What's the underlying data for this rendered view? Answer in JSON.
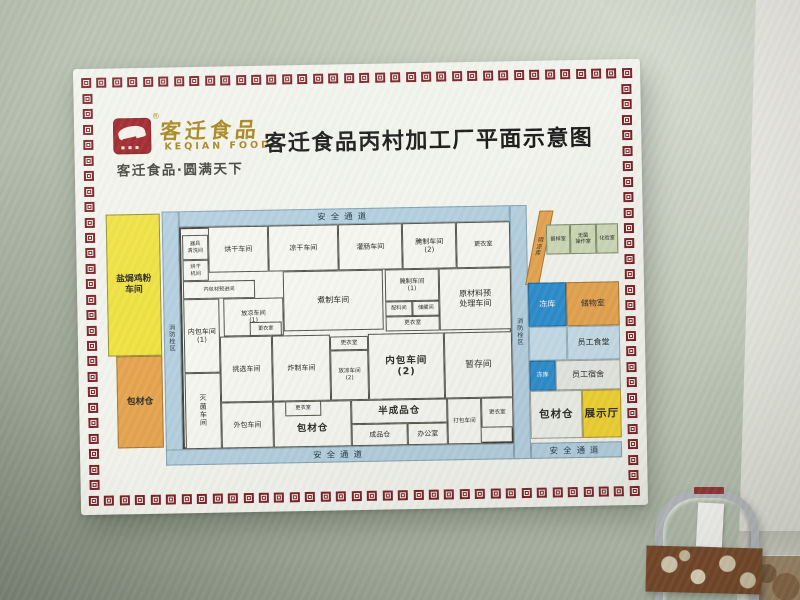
{
  "sign": {
    "logo": {
      "brand_cn": "客迁食品",
      "brand_en": "KEQIAN FOOD",
      "registered": "®",
      "slogan": "客迁食品·圆满天下"
    },
    "title": "客迁食品丙村加工厂平面示意图",
    "plan": {
      "corridors": {
        "top": "安全通道",
        "bottom": "安全通道",
        "bottom_east": "安全通道",
        "west_strip": "消\n防\n栓\n区",
        "east_strip": "消\n防\n栓\n区"
      },
      "west_rooms": {
        "salt_baked_chicken_workshop": "盐焗鸡粉\n车间",
        "packaging_material_warehouse_west": "包材仓"
      },
      "building_rooms": {
        "utensil_washing_room": "器具\n清洗间",
        "drying_machine_room": "烘干\n机间",
        "inner_pack_material_pre_room": "内包材预进间",
        "drying_workshop": "烘干车间",
        "air_drying_workshop": "凉干车间",
        "sausage_filling_workshop": "灌肠车间",
        "curing_workshop_2": "腌制车间\n(2)",
        "changing_room_ne": "更衣室",
        "cooling_workshop_1": "放凉车间\n(1)",
        "boiling_workshop": "煮制车间",
        "curing_workshop_1": "腌制车间\n(1)",
        "ingredient_room": "配料间",
        "storage_room_small": "储藏间",
        "changing_room_mid": "更衣室",
        "raw_material_pretreatment_workshop": "原材料预\n处理车间",
        "inner_packing_workshop_1": "内包车间\n(1)",
        "sterilization_workshop": "灭\n菌\n车\n间",
        "selection_workshop": "挑选车间",
        "changing_room_c1": "更衣室",
        "frying_workshop": "炸制车间",
        "changing_room_c2": "更衣室",
        "cooling_workshop_2": "放凉车间\n(2)",
        "inner_packing_workshop_2": "内包车间\n(2)",
        "temporary_storage_room": "暂存间",
        "outer_packing_workshop": "外包车间",
        "changing_room_sw": "更衣室",
        "packaging_material_warehouse_center": "包材仓",
        "semi_finished_goods_warehouse": "半成品仓",
        "finished_goods_warehouse": "成品仓",
        "office": "办公室",
        "packing_workshop": "打包车间",
        "changing_room_se": "更衣室"
      },
      "east_rooms": {
        "cool_storage": "阴\n凉\n库",
        "sample_room": "留样室",
        "sterile_operation_room": "无菌\n操作室",
        "laboratory": "化验室",
        "freezer_north": "冻库",
        "storage_room": "储物室",
        "staff_canteen": "员工食堂",
        "freezer_south": "冻库",
        "staff_dormitory": "员工宿舍",
        "packaging_material_warehouse_east": "包材仓",
        "exhibition_hall": "展示厅"
      },
      "colors": {
        "corridor_blue": "#b5d0e0",
        "workshop_yellow": "#f0e242",
        "warehouse_orange": "#e5a551",
        "freezer_blue": "#2e8ecd",
        "legend_green": "#ccd8b6",
        "exhibition_yellow": "#f2d435",
        "ornate_border_red": "#7d2127"
      }
    }
  }
}
